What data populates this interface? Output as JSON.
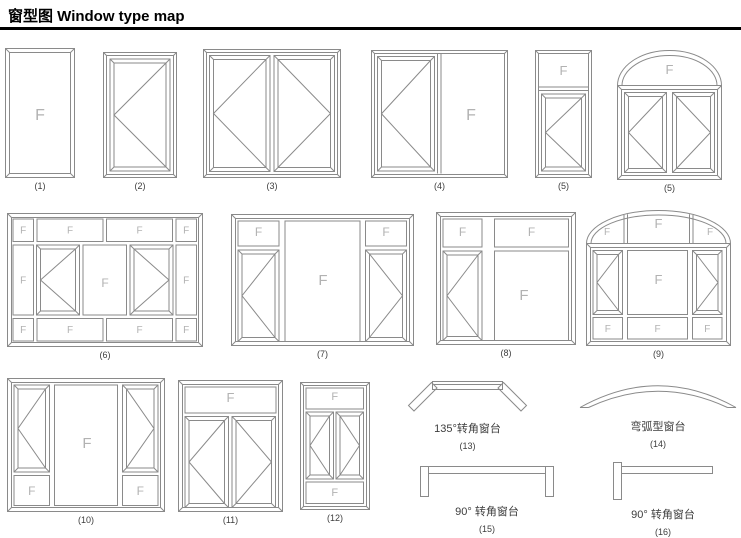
{
  "title": "窗型图 Window type map",
  "glyphs": {
    "fixed": "F"
  },
  "colors": {
    "line": "#8a8a8a",
    "fixed_label": "#b2b2b2",
    "caption": "#3d3d3d",
    "title": "#000000"
  },
  "figures": [
    {
      "label": "(1)"
    },
    {
      "label": "(2)"
    },
    {
      "label": "(3)"
    },
    {
      "label": "(4)"
    },
    {
      "label": "(5)"
    },
    {
      "label": "(5)"
    },
    {
      "label": "(6)"
    },
    {
      "label": "(7)"
    },
    {
      "label": "(8)"
    },
    {
      "label": "(9)"
    },
    {
      "label": "(10)"
    },
    {
      "label": "(11)"
    },
    {
      "label": "(12)"
    },
    {
      "label": "(13)",
      "caption": "135°转角窗台"
    },
    {
      "label": "(14)",
      "caption": "弯弧型窗台"
    },
    {
      "label": "(15)",
      "caption": "90° 转角窗台"
    },
    {
      "label": "(16)",
      "caption": "90° 转角窗台"
    }
  ]
}
